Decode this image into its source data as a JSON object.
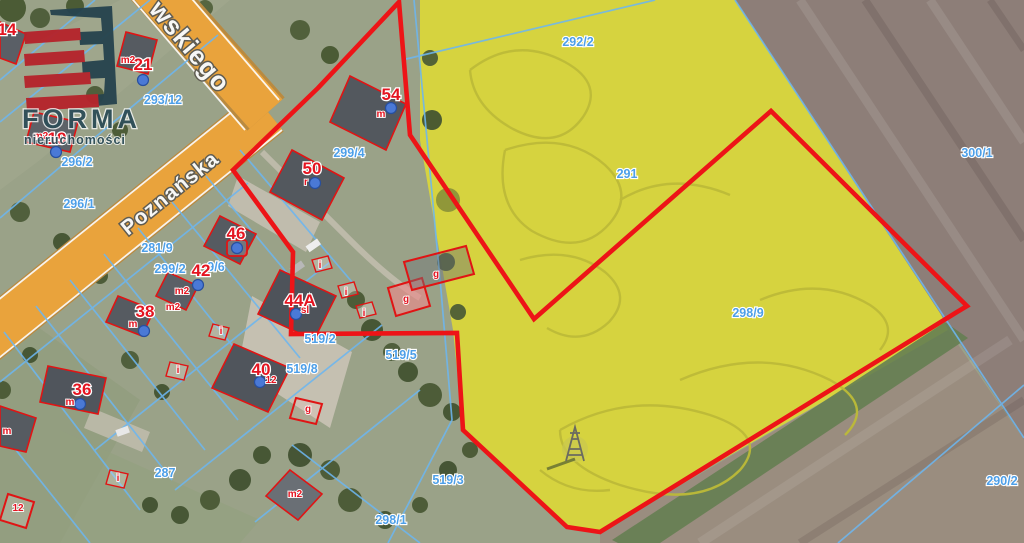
{
  "logo": {
    "line1": "FORMA",
    "line2": "nieruchomości"
  },
  "roads": {
    "main": "Poznańska",
    "top": "wskiego"
  },
  "colors": {
    "road_orange": "#e9a33c",
    "parcel_outline_red": "#ed1417",
    "cadastral_blue": "#6db6ef",
    "parcel_label_blue": "#4d9fe8",
    "house_label_red": "#e41420",
    "field_yellow": "#d6d33f",
    "field_brown": "#8d7e78",
    "logo_navy": "#2e4e58",
    "logo_red": "#b5242c"
  },
  "parcel_labels": [
    {
      "t": "293/12",
      "x": 163,
      "y": 104
    },
    {
      "t": "296/2",
      "x": 77,
      "y": 166
    },
    {
      "t": "296/1",
      "x": 79,
      "y": 208
    },
    {
      "t": "281/9",
      "x": 157,
      "y": 252
    },
    {
      "t": "299/2",
      "x": 170,
      "y": 273
    },
    {
      "t": "9/6",
      "x": 216,
      "y": 271
    },
    {
      "t": "299/4",
      "x": 349,
      "y": 157
    },
    {
      "t": "292/2",
      "x": 578,
      "y": 46
    },
    {
      "t": "291",
      "x": 627,
      "y": 178
    },
    {
      "t": "300/1",
      "x": 977,
      "y": 157
    },
    {
      "t": "298/9",
      "x": 748,
      "y": 317
    },
    {
      "t": "519/2",
      "x": 320,
      "y": 343
    },
    {
      "t": "519/8",
      "x": 302,
      "y": 373
    },
    {
      "t": "519/5",
      "x": 401,
      "y": 359
    },
    {
      "t": "519/3",
      "x": 448,
      "y": 484
    },
    {
      "t": "298/1",
      "x": 391,
      "y": 524
    },
    {
      "t": "287",
      "x": 165,
      "y": 477
    },
    {
      "t": "290/2",
      "x": 1002,
      "y": 485,
      "a": "start"
    }
  ],
  "house_labels": [
    {
      "t": "14",
      "x": 7,
      "y": 35
    },
    {
      "t": "21",
      "x": 143,
      "y": 70
    },
    {
      "t": "19",
      "x": 57,
      "y": 144
    },
    {
      "t": "54",
      "x": 391,
      "y": 100
    },
    {
      "t": "50",
      "x": 312,
      "y": 174
    },
    {
      "t": "46",
      "x": 236,
      "y": 239
    },
    {
      "t": "42",
      "x": 201,
      "y": 276
    },
    {
      "t": "44A",
      "x": 300,
      "y": 306
    },
    {
      "t": "38",
      "x": 145,
      "y": 317
    },
    {
      "t": "40",
      "x": 261,
      "y": 375
    },
    {
      "t": "36",
      "x": 82,
      "y": 395
    }
  ],
  "marker_labels": [
    {
      "t": "m2",
      "x": 128,
      "y": 63
    },
    {
      "t": "m2",
      "x": 41,
      "y": 139
    },
    {
      "t": "m",
      "x": 381,
      "y": 117
    },
    {
      "t": "r",
      "x": 306,
      "y": 185
    },
    {
      "t": "m2",
      "x": 182,
      "y": 294
    },
    {
      "t": "m2",
      "x": 173,
      "y": 310
    },
    {
      "t": "sl",
      "x": 305,
      "y": 313
    },
    {
      "t": "m",
      "x": 133,
      "y": 327
    },
    {
      "t": "12",
      "x": 271,
      "y": 383
    },
    {
      "t": "m",
      "x": 70,
      "y": 405
    },
    {
      "t": "m2",
      "x": 295,
      "y": 497
    },
    {
      "t": "m",
      "x": 7,
      "y": 434
    },
    {
      "t": "12",
      "x": 18,
      "y": 511
    },
    {
      "t": "i",
      "x": 320,
      "y": 268
    },
    {
      "t": "i",
      "x": 346,
      "y": 295
    },
    {
      "t": "i",
      "x": 364,
      "y": 316
    },
    {
      "t": "i",
      "x": 221,
      "y": 334
    },
    {
      "t": "i",
      "x": 178,
      "y": 373
    },
    {
      "t": "i",
      "x": 118,
      "y": 481
    },
    {
      "t": "g",
      "x": 406,
      "y": 302
    },
    {
      "t": "g",
      "x": 436,
      "y": 277
    },
    {
      "t": "g",
      "x": 308,
      "y": 412
    }
  ],
  "marker_dots": [
    [
      143,
      80
    ],
    [
      56,
      152
    ],
    [
      391,
      108
    ],
    [
      315,
      183
    ],
    [
      237,
      248
    ],
    [
      198,
      285
    ],
    [
      144,
      331
    ],
    [
      296,
      314
    ],
    [
      260,
      382
    ],
    [
      80,
      404
    ]
  ]
}
